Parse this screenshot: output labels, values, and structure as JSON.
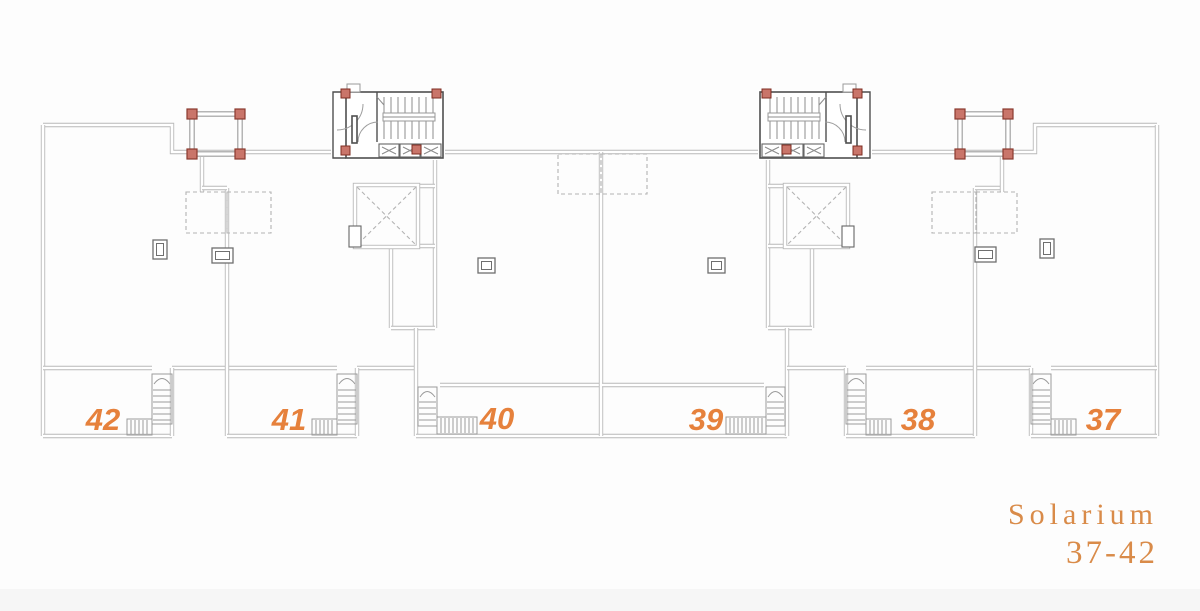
{
  "title": {
    "line1": "Solarium",
    "line2": "37-42"
  },
  "units": [
    {
      "label": "42"
    },
    {
      "label": "41"
    },
    {
      "label": "40"
    },
    {
      "label": "39"
    },
    {
      "label": "38"
    },
    {
      "label": "37"
    }
  ],
  "colors": {
    "accent": "#e6813c",
    "title": "#d98b49",
    "line": "#b9b9b9",
    "column": "#c9756a"
  }
}
